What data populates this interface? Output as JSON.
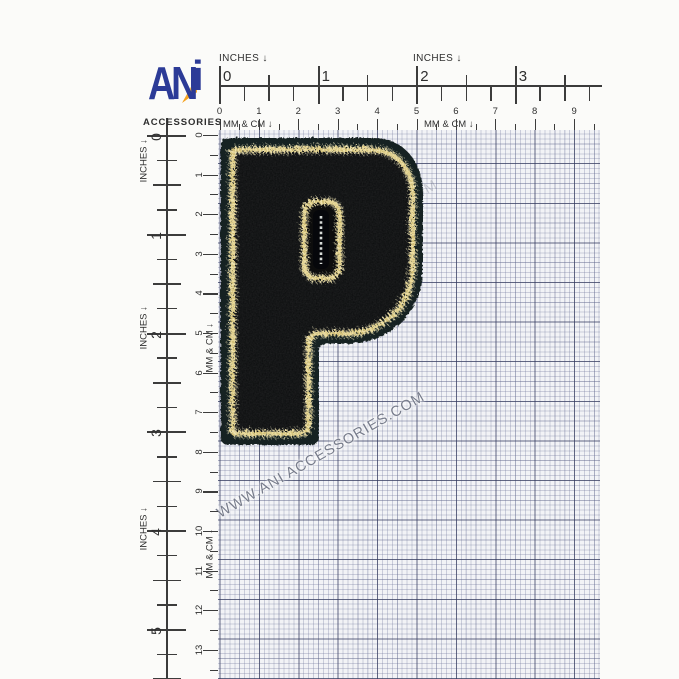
{
  "logo": {
    "an": "AN",
    "i": "i",
    "subtitle": "ACCESSORIES"
  },
  "rulers": {
    "top": {
      "inches_label": "INCHES ↓",
      "mmcm_label": "MM & CM ↓",
      "inch_numbers": [
        "0",
        "1",
        "2",
        "3"
      ],
      "cm_numbers": [
        "0",
        "1",
        "2",
        "3",
        "4",
        "5",
        "6",
        "7",
        "8",
        "9"
      ]
    },
    "left": {
      "inches_label": "INCHES ↓",
      "mmcm_label": "MM & CM ↓",
      "inch_numbers": [
        "0",
        "1",
        "2",
        "3",
        "4",
        "5"
      ],
      "cm_numbers": [
        "0",
        "1",
        "2",
        "3",
        "4",
        "5",
        "6",
        "7",
        "8",
        "9",
        "10",
        "11",
        "12",
        "13"
      ]
    }
  },
  "watermark": {
    "text": "WWW.ANI ACCESSORIES.COM"
  },
  "patch": {
    "letter": "P",
    "felt_color": "#182220",
    "chenille_color": "#0a0b0c",
    "gold_color": "#e9dda0"
  },
  "grid": {
    "bg": "#f2f3f6",
    "minor_line": "#747b9e",
    "major_line": "#2f3558"
  }
}
